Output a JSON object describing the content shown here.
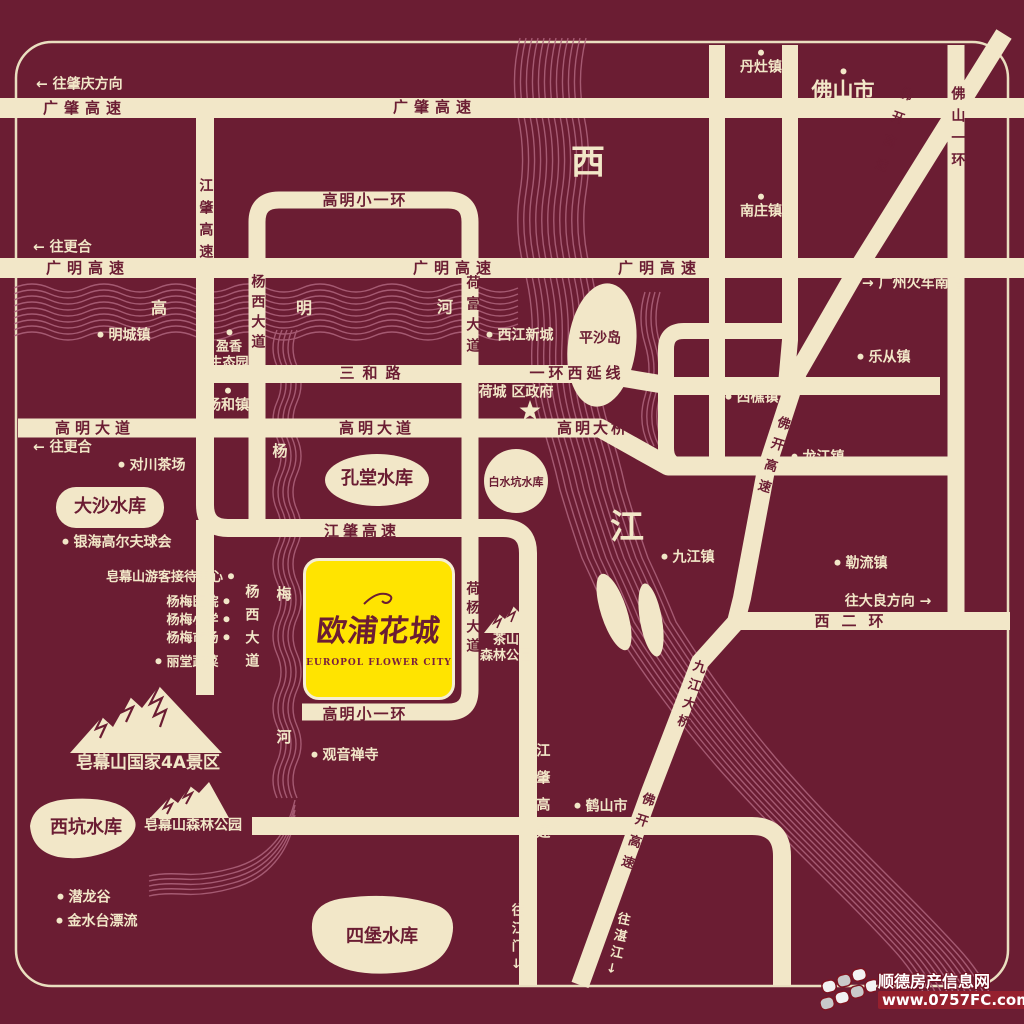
{
  "colors": {
    "background": "#6B1D33",
    "road": "#F2E7C8",
    "highlight_box": "#FFE400",
    "river_line": "#AC617A",
    "label_cream": "#F2E7C8",
    "label_maroon": "#6B1D33",
    "logo_red": "#96202E"
  },
  "project": {
    "name": "欧浦花城",
    "name_en": "EUROPOL FLOWER CITY"
  },
  "roads": {
    "guangzhao": "广肇高速",
    "guangming": "广明高速",
    "jiangzhao": "江肇高速",
    "gaoming_small_ring": "高明小一环",
    "sanhe": "三和路",
    "yihuan_west_ext": "一环西延线",
    "gaoming_avenue": "高明大道",
    "gaoming_bridge": "高明大桥",
    "xi_er_huan": "西二环",
    "yangxi_avenue": "杨西大道",
    "hefu_avenue": "荷富大道",
    "heyang_avenue": "荷杨大道",
    "foshan_yihuan": "佛山一环",
    "fokai": "佛开高速",
    "jiujiang_bridge": "九江大桥"
  },
  "directions": {
    "zhaoqing": "← 往肇庆方向",
    "genghe": "← 往更合",
    "gz_south_station": "→ 广州火车南站",
    "daliang": "往大良方向 →",
    "jiangmen": "往江门↓",
    "zhanjiang": "往湛江↓"
  },
  "places": {
    "danzao": "丹灶镇",
    "foshan": "佛山市",
    "nanzhuang": "南庄镇",
    "lecong": "乐从镇",
    "xiqiao": "西樵镇",
    "longjiang": "龙江镇",
    "leliu": "勒流镇",
    "jiujiang": "九江镇",
    "heshan": "鹤山市",
    "mingcheng": "明城镇",
    "yanghe": "杨和镇",
    "xijiang_newtown": "西江新城",
    "hecheng_gov": "荷城 区政府",
    "yingxiang_l1": "盈香",
    "yingxiang_l2": "生态园",
    "duichuan": "对川茶场",
    "yinhai": "银海高尔夫球会",
    "zaomu_visitor": "皂幕山游客接待中心",
    "yangmei_hospital": "杨梅医院",
    "yangmei_school": "杨梅小学",
    "yangmei_market": "杨梅市场",
    "litang": "丽堂蔬菜",
    "guanyin": "观音禅寺",
    "qianlong": "潜龙谷",
    "jinshuitai": "金水台漂流",
    "pingsha": "平沙岛"
  },
  "scenic": {
    "zaomu_4a": "皂幕山国家4A景区",
    "zaomu_forest": "皂幕山森林公园",
    "chashan_l1": "茶山",
    "chashan_l2": "森林公园"
  },
  "waters": {
    "dasha": "大沙水库",
    "kongtang": "孔堂水库",
    "baishuikeng": "白水坑水库",
    "xikeng": "西坑水库",
    "sibao": "四堡水库"
  },
  "rivers": {
    "xi": "西",
    "jiang": "江",
    "gao": "高",
    "ming": "明",
    "he": "河",
    "yang": "杨",
    "mei": "梅",
    "he2": "河"
  },
  "logo": {
    "site_name": "顺德房产信息网",
    "site_url": "www.0757FC.com"
  }
}
